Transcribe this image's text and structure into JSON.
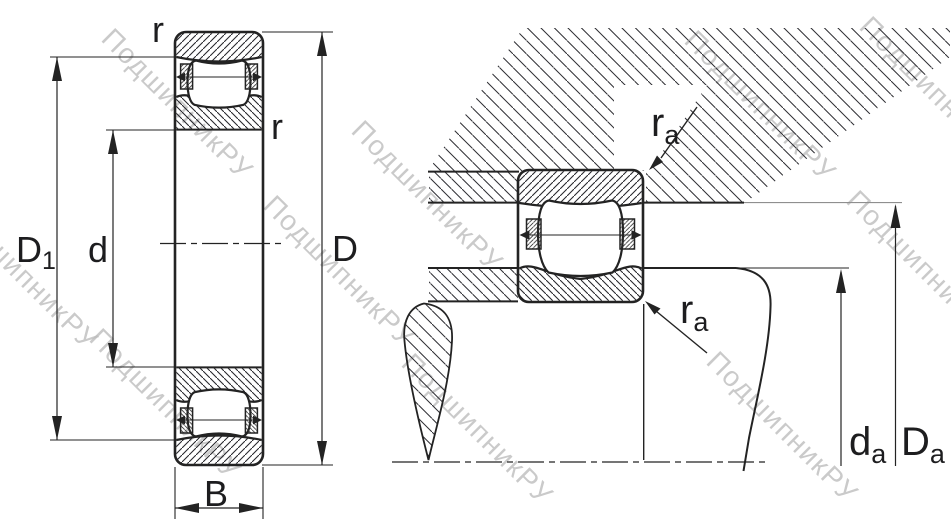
{
  "watermark": {
    "text": "ПодшипникРУ"
  },
  "labels": {
    "r_top": "r",
    "r_bore": "r",
    "D1_main": "D",
    "D1_sub": "1",
    "d_bore": "d",
    "D_outer": "D",
    "B_width": "B",
    "ra_top_main": "r",
    "ra_top_sub": "a",
    "ra_bottom_main": "r",
    "ra_bottom_sub": "a",
    "da_main": "d",
    "da_sub": "a",
    "Da_main": "D",
    "Da_sub": "a"
  },
  "colors": {
    "line": "#232323",
    "label": "#1d1d1f",
    "watermark": "#bdbdbd",
    "background": "#ffffff"
  }
}
